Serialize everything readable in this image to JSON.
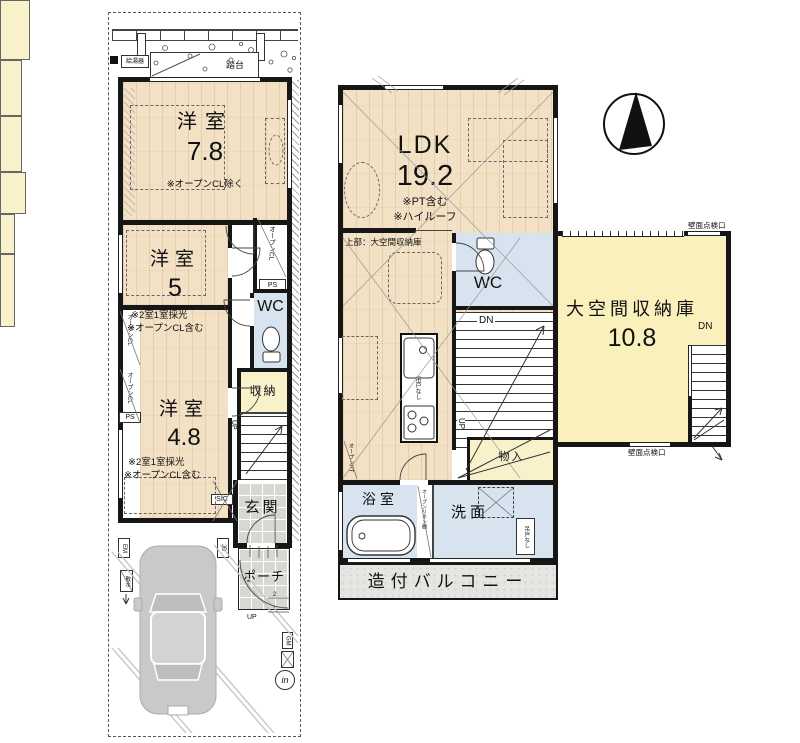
{
  "title": "間取り図",
  "colors": {
    "wood": "#f3e1c5",
    "closet_yellow": "#f9f1ca",
    "wet_blue": "#d7e4f0",
    "tile_gray": "#d7d7d3",
    "balcony_gray": "#e6e5e1",
    "loft_yellow": "#faf0bc",
    "wall_black": "#161616",
    "car_gray": "#c9c9c9"
  },
  "floor1": {
    "water_heater": "給湯器",
    "step_platform": "踏台",
    "room_78": {
      "name": "洋室",
      "area": "7.8",
      "note": "※オープンCL除く"
    },
    "room_5": {
      "name": "洋室",
      "area": "5",
      "note1": "※2室1室採光",
      "note2": "※オープンCL含む"
    },
    "room_48": {
      "name": "洋室",
      "area": "4.8",
      "note1": "※2室1室採光",
      "note2": "※オープンCL含む"
    },
    "open_closet": "オープンCL",
    "ps": "PS",
    "wc": "WC",
    "storage": "収納",
    "up": "UP",
    "sic": "SIC",
    "entrance": "玄関",
    "porch": "ポーチ",
    "em": "EM",
    "jb": "JB",
    "gm": "GM",
    "in_mark": "in",
    "sprinkler": "散水",
    "step_2": "2",
    "step_1": "1"
  },
  "floor2": {
    "ldk": {
      "name": "LDK",
      "area": "19.2",
      "note1": "※PT含む",
      "note2": "※ハイルーフ"
    },
    "upper_note": "上部：大空間収納庫",
    "wc": "WC",
    "dn": "DN",
    "up": "UP",
    "no_hanging_cupboard": "吊戸なし",
    "open_pantry": "オープンPT",
    "linen_shelf": "オープンリネン棚",
    "storage": "物入",
    "bathroom": "浴室",
    "washroom": "洗面",
    "balcony": "造付バルコニー"
  },
  "loft": {
    "name": "大空間収納庫",
    "area": "10.8",
    "dn": "DN",
    "wall_inspection": "壁面点検口"
  }
}
